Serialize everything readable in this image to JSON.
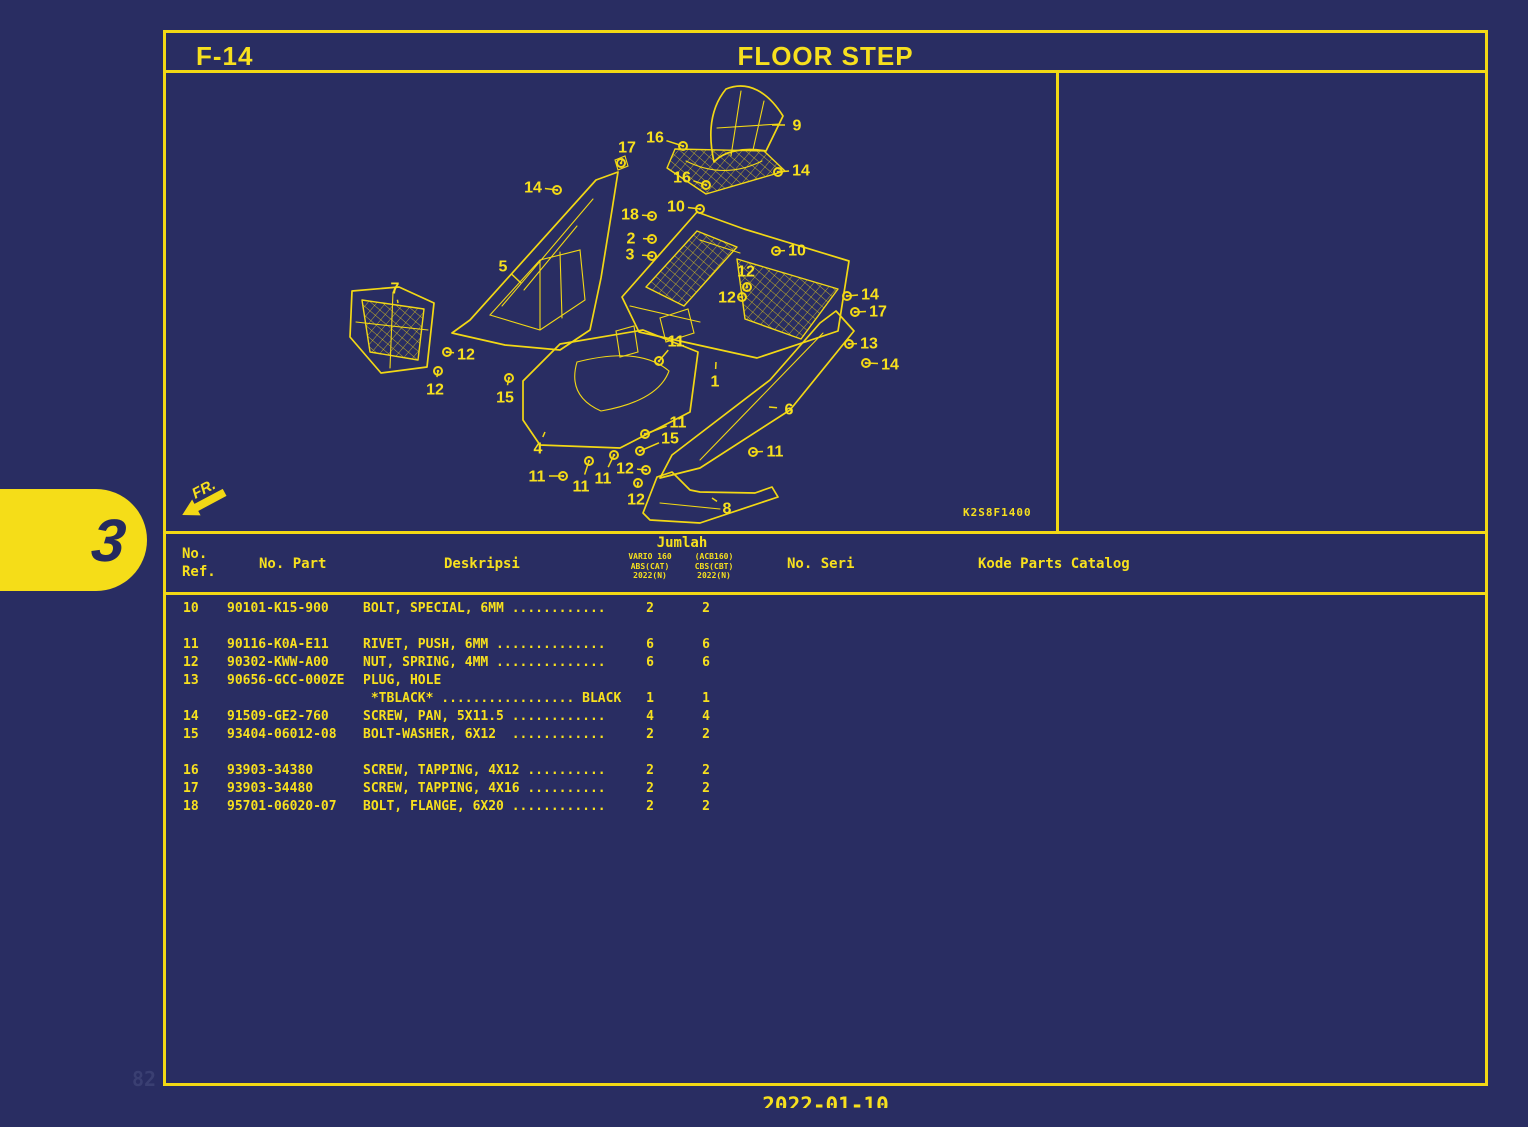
{
  "colors": {
    "background": "#292d62",
    "line_yellow": "#f2d815",
    "text_yellow": "#f7e01e",
    "tab_text_navy": "#252a5e"
  },
  "header": {
    "page_code": "F-14",
    "title": "FLOOR STEP"
  },
  "side_tab": {
    "label": "3"
  },
  "diagram": {
    "image_code": "K2S8F1400",
    "front_label": "FR.",
    "callouts": [
      {
        "n": "17",
        "x": 627,
        "y": 147,
        "tx": 621,
        "ty": 163,
        "f": 1
      },
      {
        "n": "16",
        "x": 655,
        "y": 137,
        "tx": 683,
        "ty": 146,
        "f": 1
      },
      {
        "n": "9",
        "x": 797,
        "y": 125,
        "tx": 772,
        "ty": 125,
        "f": 0
      },
      {
        "n": "14",
        "x": 801,
        "y": 170,
        "tx": 778,
        "ty": 172,
        "f": 1
      },
      {
        "n": "16",
        "x": 682,
        "y": 177,
        "tx": 706,
        "ty": 185,
        "f": 1
      },
      {
        "n": "14",
        "x": 533,
        "y": 187,
        "tx": 557,
        "ty": 190,
        "f": 1
      },
      {
        "n": "10",
        "x": 676,
        "y": 206,
        "tx": 700,
        "ty": 209,
        "f": 1
      },
      {
        "n": "18",
        "x": 630,
        "y": 214,
        "tx": 652,
        "ty": 216,
        "f": 1
      },
      {
        "n": "2",
        "x": 631,
        "y": 238,
        "tx": 652,
        "ty": 239,
        "f": 1
      },
      {
        "n": "3",
        "x": 630,
        "y": 254,
        "tx": 652,
        "ty": 256,
        "f": 1
      },
      {
        "n": "10",
        "x": 797,
        "y": 250,
        "tx": 776,
        "ty": 251,
        "f": 1
      },
      {
        "n": "5",
        "x": 503,
        "y": 266,
        "tx": 521,
        "ty": 283,
        "f": 0
      },
      {
        "n": "12",
        "x": 746,
        "y": 271,
        "tx": 747,
        "ty": 287,
        "f": 1
      },
      {
        "n": "7",
        "x": 395,
        "y": 288,
        "tx": 398,
        "ty": 303,
        "f": 0
      },
      {
        "n": "14",
        "x": 870,
        "y": 294,
        "tx": 847,
        "ty": 296,
        "f": 1
      },
      {
        "n": "12",
        "x": 727,
        "y": 297,
        "tx": 742,
        "ty": 297,
        "f": 1
      },
      {
        "n": "17",
        "x": 878,
        "y": 311,
        "tx": 855,
        "ty": 312,
        "f": 1
      },
      {
        "n": "11",
        "x": 676,
        "y": 341,
        "tx": 659,
        "ty": 361,
        "f": 1
      },
      {
        "n": "13",
        "x": 869,
        "y": 343,
        "tx": 849,
        "ty": 344,
        "f": 1
      },
      {
        "n": "12",
        "x": 466,
        "y": 354,
        "tx": 447,
        "ty": 352,
        "f": 1
      },
      {
        "n": "14",
        "x": 890,
        "y": 364,
        "tx": 866,
        "ty": 363,
        "f": 1
      },
      {
        "n": "1",
        "x": 715,
        "y": 381,
        "tx": 716,
        "ty": 362,
        "f": 0
      },
      {
        "n": "12",
        "x": 435,
        "y": 389,
        "tx": 438,
        "ty": 371,
        "f": 1
      },
      {
        "n": "15",
        "x": 505,
        "y": 397,
        "tx": 509,
        "ty": 378,
        "f": 1
      },
      {
        "n": "6",
        "x": 789,
        "y": 409,
        "tx": 769,
        "ty": 407,
        "f": 0
      },
      {
        "n": "11",
        "x": 678,
        "y": 422,
        "tx": 645,
        "ty": 434,
        "f": 1
      },
      {
        "n": "15",
        "x": 670,
        "y": 438,
        "tx": 640,
        "ty": 451,
        "f": 1
      },
      {
        "n": "4",
        "x": 538,
        "y": 448,
        "tx": 545,
        "ty": 432,
        "f": 0
      },
      {
        "n": "11",
        "x": 775,
        "y": 451,
        "tx": 753,
        "ty": 452,
        "f": 1
      },
      {
        "n": "12",
        "x": 625,
        "y": 468,
        "tx": 646,
        "ty": 470,
        "f": 1
      },
      {
        "n": "11",
        "x": 537,
        "y": 476,
        "tx": 563,
        "ty": 476,
        "f": 1
      },
      {
        "n": "11",
        "x": 603,
        "y": 478,
        "tx": 614,
        "ty": 455,
        "f": 1
      },
      {
        "n": "11",
        "x": 581,
        "y": 486,
        "tx": 589,
        "ty": 461,
        "f": 1
      },
      {
        "n": "12",
        "x": 636,
        "y": 499,
        "tx": 638,
        "ty": 483,
        "f": 1
      },
      {
        "n": "8",
        "x": 727,
        "y": 508,
        "tx": 712,
        "ty": 498,
        "f": 0
      }
    ]
  },
  "table": {
    "headers": {
      "ref_line1": "No.",
      "ref_line2": "Ref.",
      "part": "No. Part",
      "desc": "Deskripsi",
      "qty_group": "Jumlah",
      "qty_model1": "VARIO 160",
      "qty_model2": "(ACB160)",
      "qty_col1": "ABS(CAT)",
      "qty_col2": "CBS(CBT)",
      "qty_year1": "2022(N)",
      "qty_year2": "2022(N)",
      "seri": "No. Seri",
      "catalog": "Kode Parts Catalog"
    },
    "rows": [
      {
        "gap": false,
        "ref": "10",
        "part": "90101-K15-900",
        "lines": [
          {
            "d": "BOLT, SPECIAL, 6MM ............",
            "q1": "2",
            "q2": "2"
          }
        ]
      },
      {
        "gap": true,
        "ref": "11",
        "part": "90116-K0A-E11",
        "lines": [
          {
            "d": "RIVET, PUSH, 6MM ..............",
            "q1": "6",
            "q2": "6"
          }
        ]
      },
      {
        "gap": false,
        "ref": "12",
        "part": "90302-KWW-A00",
        "lines": [
          {
            "d": "NUT, SPRING, 4MM ..............",
            "q1": "6",
            "q2": "6"
          }
        ]
      },
      {
        "gap": false,
        "ref": "13",
        "part": "90656-GCC-000ZE",
        "lines": [
          {
            "d": "PLUG, HOLE",
            "q1": "",
            "q2": ""
          },
          {
            "d": " *TBLACK* ................. BLACK",
            "q1": "1",
            "q2": "1"
          }
        ]
      },
      {
        "gap": false,
        "ref": "14",
        "part": "91509-GE2-760",
        "lines": [
          {
            "d": "SCREW, PAN, 5X11.5 ............",
            "q1": "4",
            "q2": "4"
          }
        ]
      },
      {
        "gap": false,
        "ref": "15",
        "part": "93404-06012-08",
        "lines": [
          {
            "d": "BOLT-WASHER, 6X12  ............",
            "q1": "2",
            "q2": "2"
          }
        ]
      },
      {
        "gap": true,
        "ref": "16",
        "part": "93903-34380",
        "lines": [
          {
            "d": "SCREW, TAPPING, 4X12 ..........",
            "q1": "2",
            "q2": "2"
          }
        ]
      },
      {
        "gap": false,
        "ref": "17",
        "part": "93903-34480",
        "lines": [
          {
            "d": "SCREW, TAPPING, 4X16 ..........",
            "q1": "2",
            "q2": "2"
          }
        ]
      },
      {
        "gap": false,
        "ref": "18",
        "part": "95701-06020-07",
        "lines": [
          {
            "d": "BOLT, FLANGE, 6X20 ............",
            "q1": "2",
            "q2": "2"
          }
        ]
      }
    ]
  },
  "footer": {
    "date": "2022-01-10",
    "watermark": "82"
  }
}
